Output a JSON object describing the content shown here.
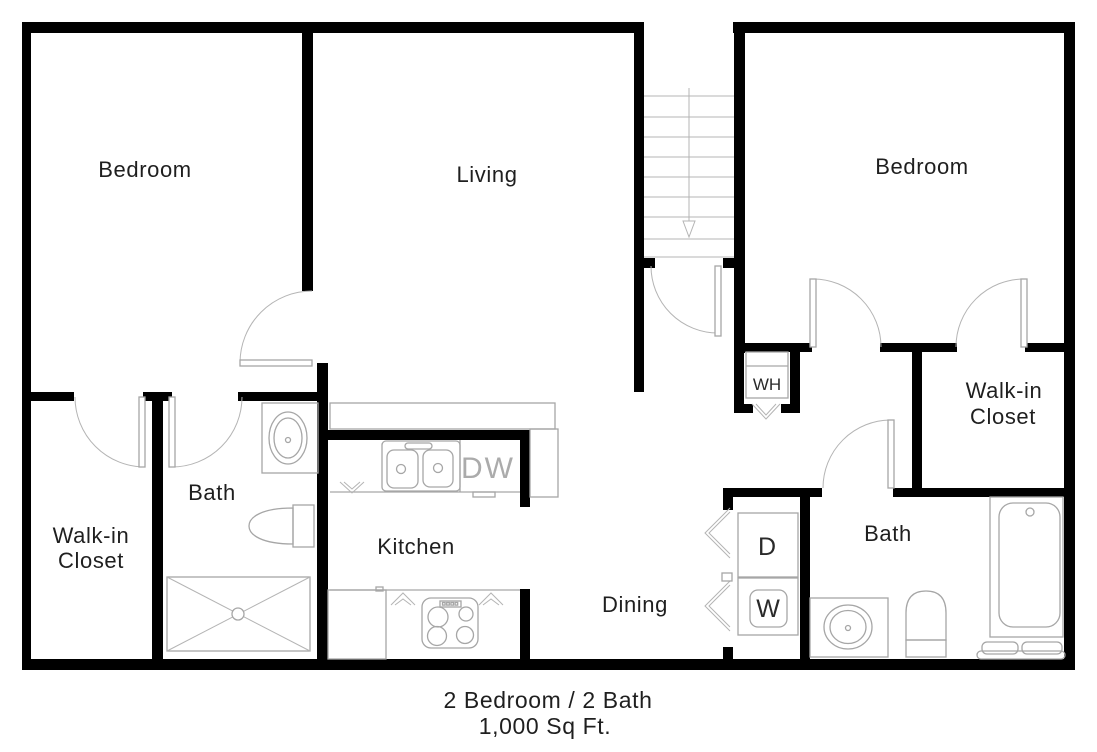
{
  "plan": {
    "caption": {
      "line1": "2 Bedroom / 2 Bath",
      "line2": "1,000 Sq Ft."
    },
    "rooms": {
      "bedroom_left": "Bedroom",
      "living": "Living",
      "bedroom_right": "Bedroom",
      "walkin_line1": "Walk-in",
      "walkin_line2": "Closet",
      "bath": "Bath",
      "kitchen": "Kitchen",
      "dining": "Dining"
    },
    "appliances": {
      "water_heater": "WH",
      "dryer": "D",
      "washer": "W",
      "dishwasher": "DW"
    },
    "colors": {
      "wall": "#000000",
      "fixture_outline": "#a6a6a6",
      "stair_line": "#b4b4b4",
      "label_text": "#1f1f1f",
      "dishwasher_text": "#ababab",
      "background": "#ffffff"
    }
  }
}
